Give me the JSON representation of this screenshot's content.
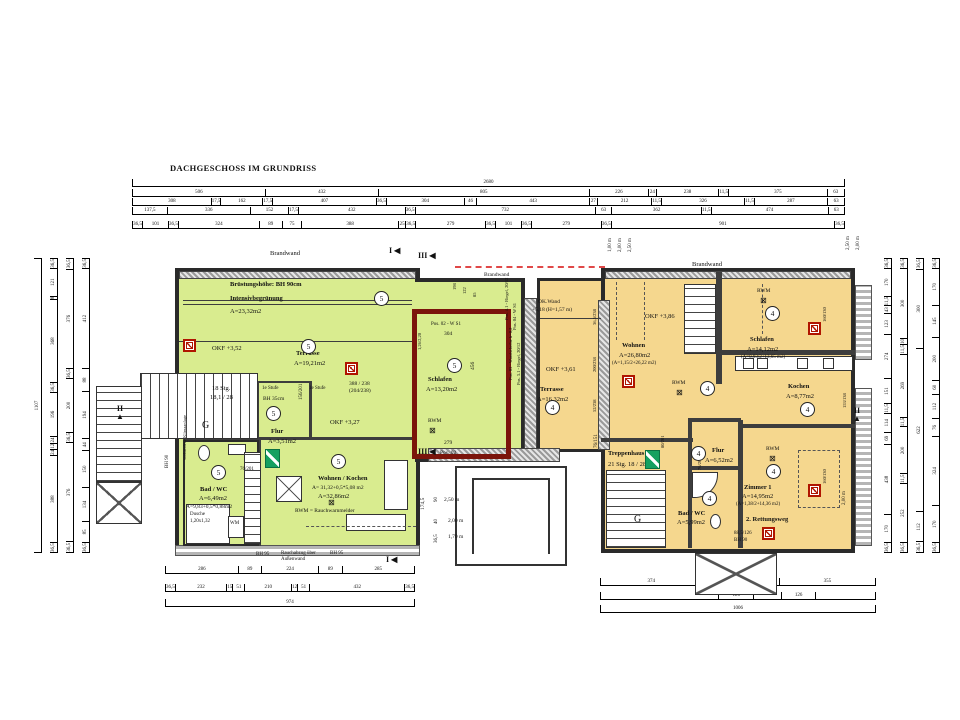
{
  "title": "DACHGESCHOSS IM GRUNDRISS",
  "colors": {
    "unit_left_fill": "#d9ec8f",
    "unit_right_fill": "#f5d78e",
    "wall": "#3d3d3d",
    "highlight_outline": "#7b140b",
    "brandwand_dash": "#e04848",
    "exit_green": "#15a060",
    "escape_red": "#b01500"
  },
  "legend": {
    "rwm": "RWM = Rauchwarnmelder"
  },
  "dims": {
    "top": {
      "r1": [
        "2680"
      ],
      "r2": [
        "506",
        "432",
        "805",
        "226",
        "24",
        "238",
        "11,5",
        "375",
        "63"
      ],
      "r3": [
        "308",
        "17,5",
        "162",
        "17,5",
        "407",
        "36,5",
        "304",
        "46",
        "443",
        "27",
        "212",
        "11,5",
        "326",
        "11,5",
        "287",
        "63"
      ],
      "r4": [
        "137,5",
        "336",
        "152",
        "17,5",
        "432",
        "36,5",
        "732",
        "63",
        "362",
        "11,5",
        "474",
        "63"
      ],
      "r5": [
        "36,5",
        "101",
        "36,5",
        "324",
        "89",
        "75",
        "388",
        "25",
        "36,5",
        "279",
        "36,5",
        "101",
        "36,5",
        "279",
        "36,5",
        "901",
        "36,5"
      ]
    },
    "bottom_left": {
      "b1": [
        "286",
        "89",
        "224",
        "89",
        "285"
      ],
      "b2": [
        "36,5",
        "232",
        "15",
        "51",
        "210",
        "12",
        "51",
        "432",
        "36,5"
      ],
      "b3": [
        "974"
      ]
    },
    "bottom_right": {
      "c1": [
        "374",
        "89",
        "99",
        "89",
        "355"
      ],
      "c2": [
        {
          "w": 437,
          "t": ""
        },
        {
          "w": 126,
          "t": "126"
        },
        {
          "w": 99,
          "t": ""
        },
        {
          "w": 126,
          "t": "126"
        },
        {
          "w": 218,
          "t": ""
        }
      ],
      "c3": [
        "1006"
      ]
    },
    "left_v": {
      "c1": [
        "1107"
      ],
      "c2": [
        "36,5",
        "121",
        "8",
        "368",
        "36,5",
        "196",
        "24",
        "12",
        "24",
        "388",
        "36,5"
      ],
      "c3": [
        "36,5",
        "376",
        "36,5",
        "200",
        "36,5",
        "376",
        "36,5"
      ],
      "c4": [
        "36,5",
        "412",
        "88",
        "194",
        "44",
        "150",
        "134",
        "85",
        "36,5"
      ]
    },
    "right_v": {
      "c1": [
        "36,5",
        "170",
        "11,5",
        "43",
        "123",
        "274",
        "151",
        "11,5",
        "114",
        "69",
        "438",
        "170",
        "36,5"
      ],
      "c2": [
        "36,5",
        "300",
        "10",
        "11,5",
        "269",
        "11,5",
        "200",
        "11,5",
        "252",
        "36,5"
      ],
      "c3": [
        "36,5",
        "300",
        "622",
        "112",
        "36,5"
      ],
      "c4": [
        "36,5",
        "170",
        "145",
        "200",
        "60",
        "112",
        "76",
        "324",
        "170",
        "36,5"
      ]
    }
  },
  "annotations": [
    {
      "t": "Brandwand",
      "x": 270,
      "y": 250
    },
    {
      "t": "Brüstungshöhe: BH 90cm",
      "x": 230,
      "y": 281,
      "b": 1
    },
    {
      "t": "Intensivbegrünung",
      "x": 230,
      "y": 295,
      "b": 1
    },
    {
      "t": "A=23,32m2",
      "x": 230,
      "y": 308
    },
    {
      "t": "OKF +3,52",
      "x": 212,
      "y": 345
    },
    {
      "t": "Terrasse",
      "x": 296,
      "y": 350,
      "b": 1
    },
    {
      "t": "A=19,21m2",
      "x": 294,
      "y": 360
    },
    {
      "t": "18 Stg.",
      "x": 212,
      "y": 385
    },
    {
      "t": "18,1 / 28",
      "x": 210,
      "y": 394
    },
    {
      "t": "G",
      "x": 202,
      "y": 420,
      "s": 10
    },
    {
      "t": "1e Stufe",
      "x": 262,
      "y": 386,
      "s": 5
    },
    {
      "t": "1e Stufe",
      "x": 309,
      "y": 386,
      "s": 5
    },
    {
      "t": "BH 35cm",
      "x": 263,
      "y": 396,
      "s": 5.5
    },
    {
      "t": "Flur",
      "x": 271,
      "y": 428,
      "b": 1
    },
    {
      "t": "A=3,51m2",
      "x": 268,
      "y": 438
    },
    {
      "t": "OKF +3,27",
      "x": 330,
      "y": 419
    },
    {
      "t": "388 / 238",
      "x": 349,
      "y": 381,
      "s": 5.5
    },
    {
      "t": "(204/238)",
      "x": 349,
      "y": 388,
      "s": 5.5
    },
    {
      "t": "156/201",
      "x": 299,
      "y": 400,
      "r": 1,
      "s": 5
    },
    {
      "t": "76/201",
      "x": 240,
      "y": 467,
      "s": 5
    },
    {
      "t": "Bad / WC",
      "x": 200,
      "y": 486,
      "b": 1
    },
    {
      "t": "A=6,49m2",
      "x": 199,
      "y": 495
    },
    {
      "t": "A=9,83+0,5*0,88m2",
      "x": 186,
      "y": 504,
      "s": 5.5
    },
    {
      "t": "Dusche",
      "x": 190,
      "y": 512,
      "s": 5
    },
    {
      "t": "1,20x1,32",
      "x": 190,
      "y": 519,
      "s": 5
    },
    {
      "t": "WM",
      "x": 230,
      "y": 521,
      "s": 5
    },
    {
      "t": "vorhandene Klimaanlage",
      "x": 182,
      "y": 460,
      "r": 1,
      "s": 4.5
    },
    {
      "t": "Wohnen / Kochen",
      "x": 318,
      "y": 475,
      "b": 1
    },
    {
      "t": "A= 31,32+0,5*5,08 m2",
      "x": 312,
      "y": 485,
      "s": 5.5
    },
    {
      "t": "A=32,86m2",
      "x": 318,
      "y": 493
    },
    {
      "t": "RWM = Rauchwarnmelder",
      "x": 295,
      "y": 508,
      "s": 5.5
    },
    {
      "t": "Schlafen",
      "x": 428,
      "y": 376,
      "b": 1
    },
    {
      "t": "A=13,20m2",
      "x": 426,
      "y": 386
    },
    {
      "t": "RWM",
      "x": 428,
      "y": 418,
      "s": 5.5
    },
    {
      "t": "Pos. 02 - W S1",
      "x": 431,
      "y": 322,
      "s": 5
    },
    {
      "t": "304",
      "x": 444,
      "y": 331,
      "s": 5.5
    },
    {
      "t": "279",
      "x": 444,
      "y": 440,
      "s": 5.5
    },
    {
      "t": "456",
      "x": 470,
      "y": 370,
      "r": 1,
      "s": 5.5
    },
    {
      "t": "1,26/2,20",
      "x": 417,
      "y": 350,
      "r": 1,
      "s": 4.5
    },
    {
      "t": "Pos. 4.1 - Riegel, 20/12",
      "x": 504,
      "y": 320,
      "r": 1,
      "s": 4.5
    },
    {
      "t": "Pos. 04 - W S1",
      "x": 512,
      "y": 330,
      "r": 1,
      "s": 4.5
    },
    {
      "t": "Pos. 03 - Wandscheibe b=0,2",
      "x": 508,
      "y": 380,
      "r": 1,
      "s": 4.5
    },
    {
      "t": "Pos. 3.1 - Riegel, 20/12",
      "x": 516,
      "y": 385,
      "r": 1,
      "s": 4.5
    },
    {
      "t": "198",
      "x": 452,
      "y": 290,
      "r": 1,
      "s": 4.5
    },
    {
      "t": "122",
      "x": 462,
      "y": 294,
      "r": 1,
      "s": 4.5
    },
    {
      "t": "85",
      "x": 472,
      "y": 297,
      "r": 1,
      "s": 4.5
    },
    {
      "t": "BH 95",
      "x": 256,
      "y": 552,
      "s": 5
    },
    {
      "t": "Rauchabzug über",
      "x": 281,
      "y": 551,
      "s": 5
    },
    {
      "t": "Außenwand",
      "x": 281,
      "y": 557,
      "s": 5
    },
    {
      "t": "BH 95",
      "x": 330,
      "y": 551,
      "s": 5
    },
    {
      "t": "BH 90",
      "x": 165,
      "y": 468,
      "r": 1,
      "s": 5
    },
    {
      "t": "2,50 m",
      "x": 444,
      "y": 497,
      "s": 5.5
    },
    {
      "t": "2,00 m",
      "x": 448,
      "y": 518,
      "s": 5.5
    },
    {
      "t": "1,70 m",
      "x": 448,
      "y": 534,
      "s": 5.5
    },
    {
      "t": "174,5",
      "x": 420,
      "y": 510,
      "r": 1,
      "s": 5.5
    },
    {
      "t": "90",
      "x": 434,
      "y": 502,
      "r": 1,
      "s": 5
    },
    {
      "t": "40",
      "x": 434,
      "y": 524,
      "r": 1,
      "s": 5
    },
    {
      "t": "36,5",
      "x": 434,
      "y": 543,
      "r": 1,
      "s": 5
    },
    {
      "t": "76/151",
      "x": 594,
      "y": 448,
      "r": 1,
      "s": 5
    },
    {
      "t": "Pos. 02",
      "x": 440,
      "y": 450,
      "s": 5.5
    },
    {
      "t": "Brandwand",
      "x": 484,
      "y": 272,
      "s": 5.5
    },
    {
      "t": "Brandwand",
      "x": 692,
      "y": 261
    },
    {
      "t": "OK.Wand",
      "x": 538,
      "y": 299,
      "s": 5.5
    },
    {
      "t": "+5,18 (H=1,57 m)",
      "x": 532,
      "y": 307,
      "s": 5.5
    },
    {
      "t": "OKF +3,61",
      "x": 546,
      "y": 366
    },
    {
      "t": "Terrasse",
      "x": 540,
      "y": 386,
      "b": 1
    },
    {
      "t": "A=16,32m2",
      "x": 537,
      "y": 396
    },
    {
      "t": "36,5/238",
      "x": 592,
      "y": 325,
      "r": 1,
      "s": 4.5
    },
    {
      "t": "200/238",
      "x": 592,
      "y": 372,
      "r": 1,
      "s": 4.5
    },
    {
      "t": "52/238",
      "x": 592,
      "y": 412,
      "r": 1,
      "s": 4.5
    },
    {
      "t": "1,00 m",
      "x": 608,
      "y": 252,
      "r": 1,
      "s": 5
    },
    {
      "t": "2,00 m",
      "x": 618,
      "y": 252,
      "r": 1,
      "s": 5
    },
    {
      "t": "2,50 m",
      "x": 628,
      "y": 252,
      "r": 1,
      "s": 5
    },
    {
      "t": "2,50 m",
      "x": 846,
      "y": 250,
      "r": 1,
      "s": 5
    },
    {
      "t": "2,00 m",
      "x": 856,
      "y": 250,
      "r": 1,
      "s": 5
    },
    {
      "t": "OKF +3,86",
      "x": 645,
      "y": 313
    },
    {
      "t": "Wohnen",
      "x": 622,
      "y": 342,
      "b": 1
    },
    {
      "t": "A=26,80m2",
      "x": 619,
      "y": 352
    },
    {
      "t": "(A=1,15/2+26,22 m2)",
      "x": 612,
      "y": 361,
      "s": 5
    },
    {
      "t": "RWM",
      "x": 672,
      "y": 380,
      "s": 5.5
    },
    {
      "t": "Schlafen",
      "x": 750,
      "y": 336,
      "b": 1
    },
    {
      "t": "A=14,12m2",
      "x": 747,
      "y": 346
    },
    {
      "t": "(A=0,93/2+13,65 m2)",
      "x": 741,
      "y": 355,
      "s": 5
    },
    {
      "t": "RWM",
      "x": 757,
      "y": 288,
      "s": 5.5
    },
    {
      "t": "Kochen",
      "x": 788,
      "y": 383,
      "b": 1
    },
    {
      "t": "A=8,77m2",
      "x": 786,
      "y": 393
    },
    {
      "t": "Flur",
      "x": 712,
      "y": 447,
      "b": 1
    },
    {
      "t": "A=6,52m2",
      "x": 705,
      "y": 457
    },
    {
      "t": "Treppenhaus",
      "x": 608,
      "y": 450,
      "b": 1
    },
    {
      "t": "21 Stg. 18 / 28",
      "x": 608,
      "y": 461
    },
    {
      "t": "G",
      "x": 634,
      "y": 514,
      "s": 10
    },
    {
      "t": "Bad / WC",
      "x": 678,
      "y": 510,
      "b": 1
    },
    {
      "t": "A=5,99m2",
      "x": 677,
      "y": 519
    },
    {
      "t": "RWM",
      "x": 766,
      "y": 446,
      "s": 5.5
    },
    {
      "t": "Zimmer 1",
      "x": 744,
      "y": 484,
      "b": 1
    },
    {
      "t": "A=14,95m2",
      "x": 742,
      "y": 493
    },
    {
      "t": "(A=1,38/2+14,36 m2)",
      "x": 736,
      "y": 502,
      "s": 5
    },
    {
      "t": "2. Rettungsweg",
      "x": 746,
      "y": 516,
      "b": 1
    },
    {
      "t": "88,5/126",
      "x": 734,
      "y": 531,
      "s": 5
    },
    {
      "t": "BH 90",
      "x": 734,
      "y": 538,
      "s": 5
    },
    {
      "t": "160/130",
      "x": 822,
      "y": 322,
      "r": 1,
      "s": 4.5
    },
    {
      "t": "160/130",
      "x": 822,
      "y": 484,
      "r": 1,
      "s": 4.5
    },
    {
      "t": "153/138",
      "x": 842,
      "y": 408,
      "r": 1,
      "s": 4.5
    },
    {
      "t": "2,00 m",
      "x": 842,
      "y": 505,
      "r": 1,
      "s": 5
    },
    {
      "t": "80/201",
      "x": 660,
      "y": 448,
      "r": 1,
      "s": 4.5
    },
    {
      "t": "76/201",
      "x": 697,
      "y": 470,
      "r": 1,
      "s": 4.5
    }
  ],
  "circles": [
    {
      "n": "5",
      "x": 374,
      "y": 291
    },
    {
      "n": "5",
      "x": 301,
      "y": 339
    },
    {
      "n": "5",
      "x": 266,
      "y": 406
    },
    {
      "n": "5",
      "x": 211,
      "y": 465
    },
    {
      "n": "5",
      "x": 331,
      "y": 454
    },
    {
      "n": "5",
      "x": 447,
      "y": 358
    },
    {
      "n": "4",
      "x": 545,
      "y": 400
    },
    {
      "n": "4",
      "x": 700,
      "y": 381
    },
    {
      "n": "4",
      "x": 765,
      "y": 306
    },
    {
      "n": "4",
      "x": 800,
      "y": 402
    },
    {
      "n": "4",
      "x": 691,
      "y": 446
    },
    {
      "n": "4",
      "x": 702,
      "y": 491
    },
    {
      "n": "4",
      "x": 766,
      "y": 464
    }
  ],
  "icons": {
    "smoke_glyph": "⊠",
    "escape_windows": [
      [
        183,
        339
      ],
      [
        345,
        362
      ],
      [
        622,
        375
      ],
      [
        808,
        322
      ],
      [
        808,
        484
      ],
      [
        762,
        527
      ]
    ],
    "smoke_detectors": [
      [
        429,
        427
      ],
      [
        328,
        499
      ],
      [
        676,
        389
      ],
      [
        760,
        297
      ],
      [
        769,
        455
      ]
    ],
    "exit_signs": [
      [
        265,
        449
      ],
      [
        645,
        450
      ]
    ]
  },
  "markers": [
    {
      "t": "I",
      "g": "◀",
      "x": 389,
      "y": 246
    },
    {
      "t": "III",
      "g": "◀",
      "x": 418,
      "y": 251
    },
    {
      "t": "III",
      "g": "◀",
      "x": 418,
      "y": 447
    },
    {
      "t": "I",
      "g": "◀",
      "x": 386,
      "y": 555
    },
    {
      "t": "II",
      "g": "▲",
      "x": 116,
      "y": 405,
      "stack": true
    },
    {
      "t": "II",
      "g": "▲",
      "x": 853,
      "y": 407,
      "stack": true
    }
  ]
}
